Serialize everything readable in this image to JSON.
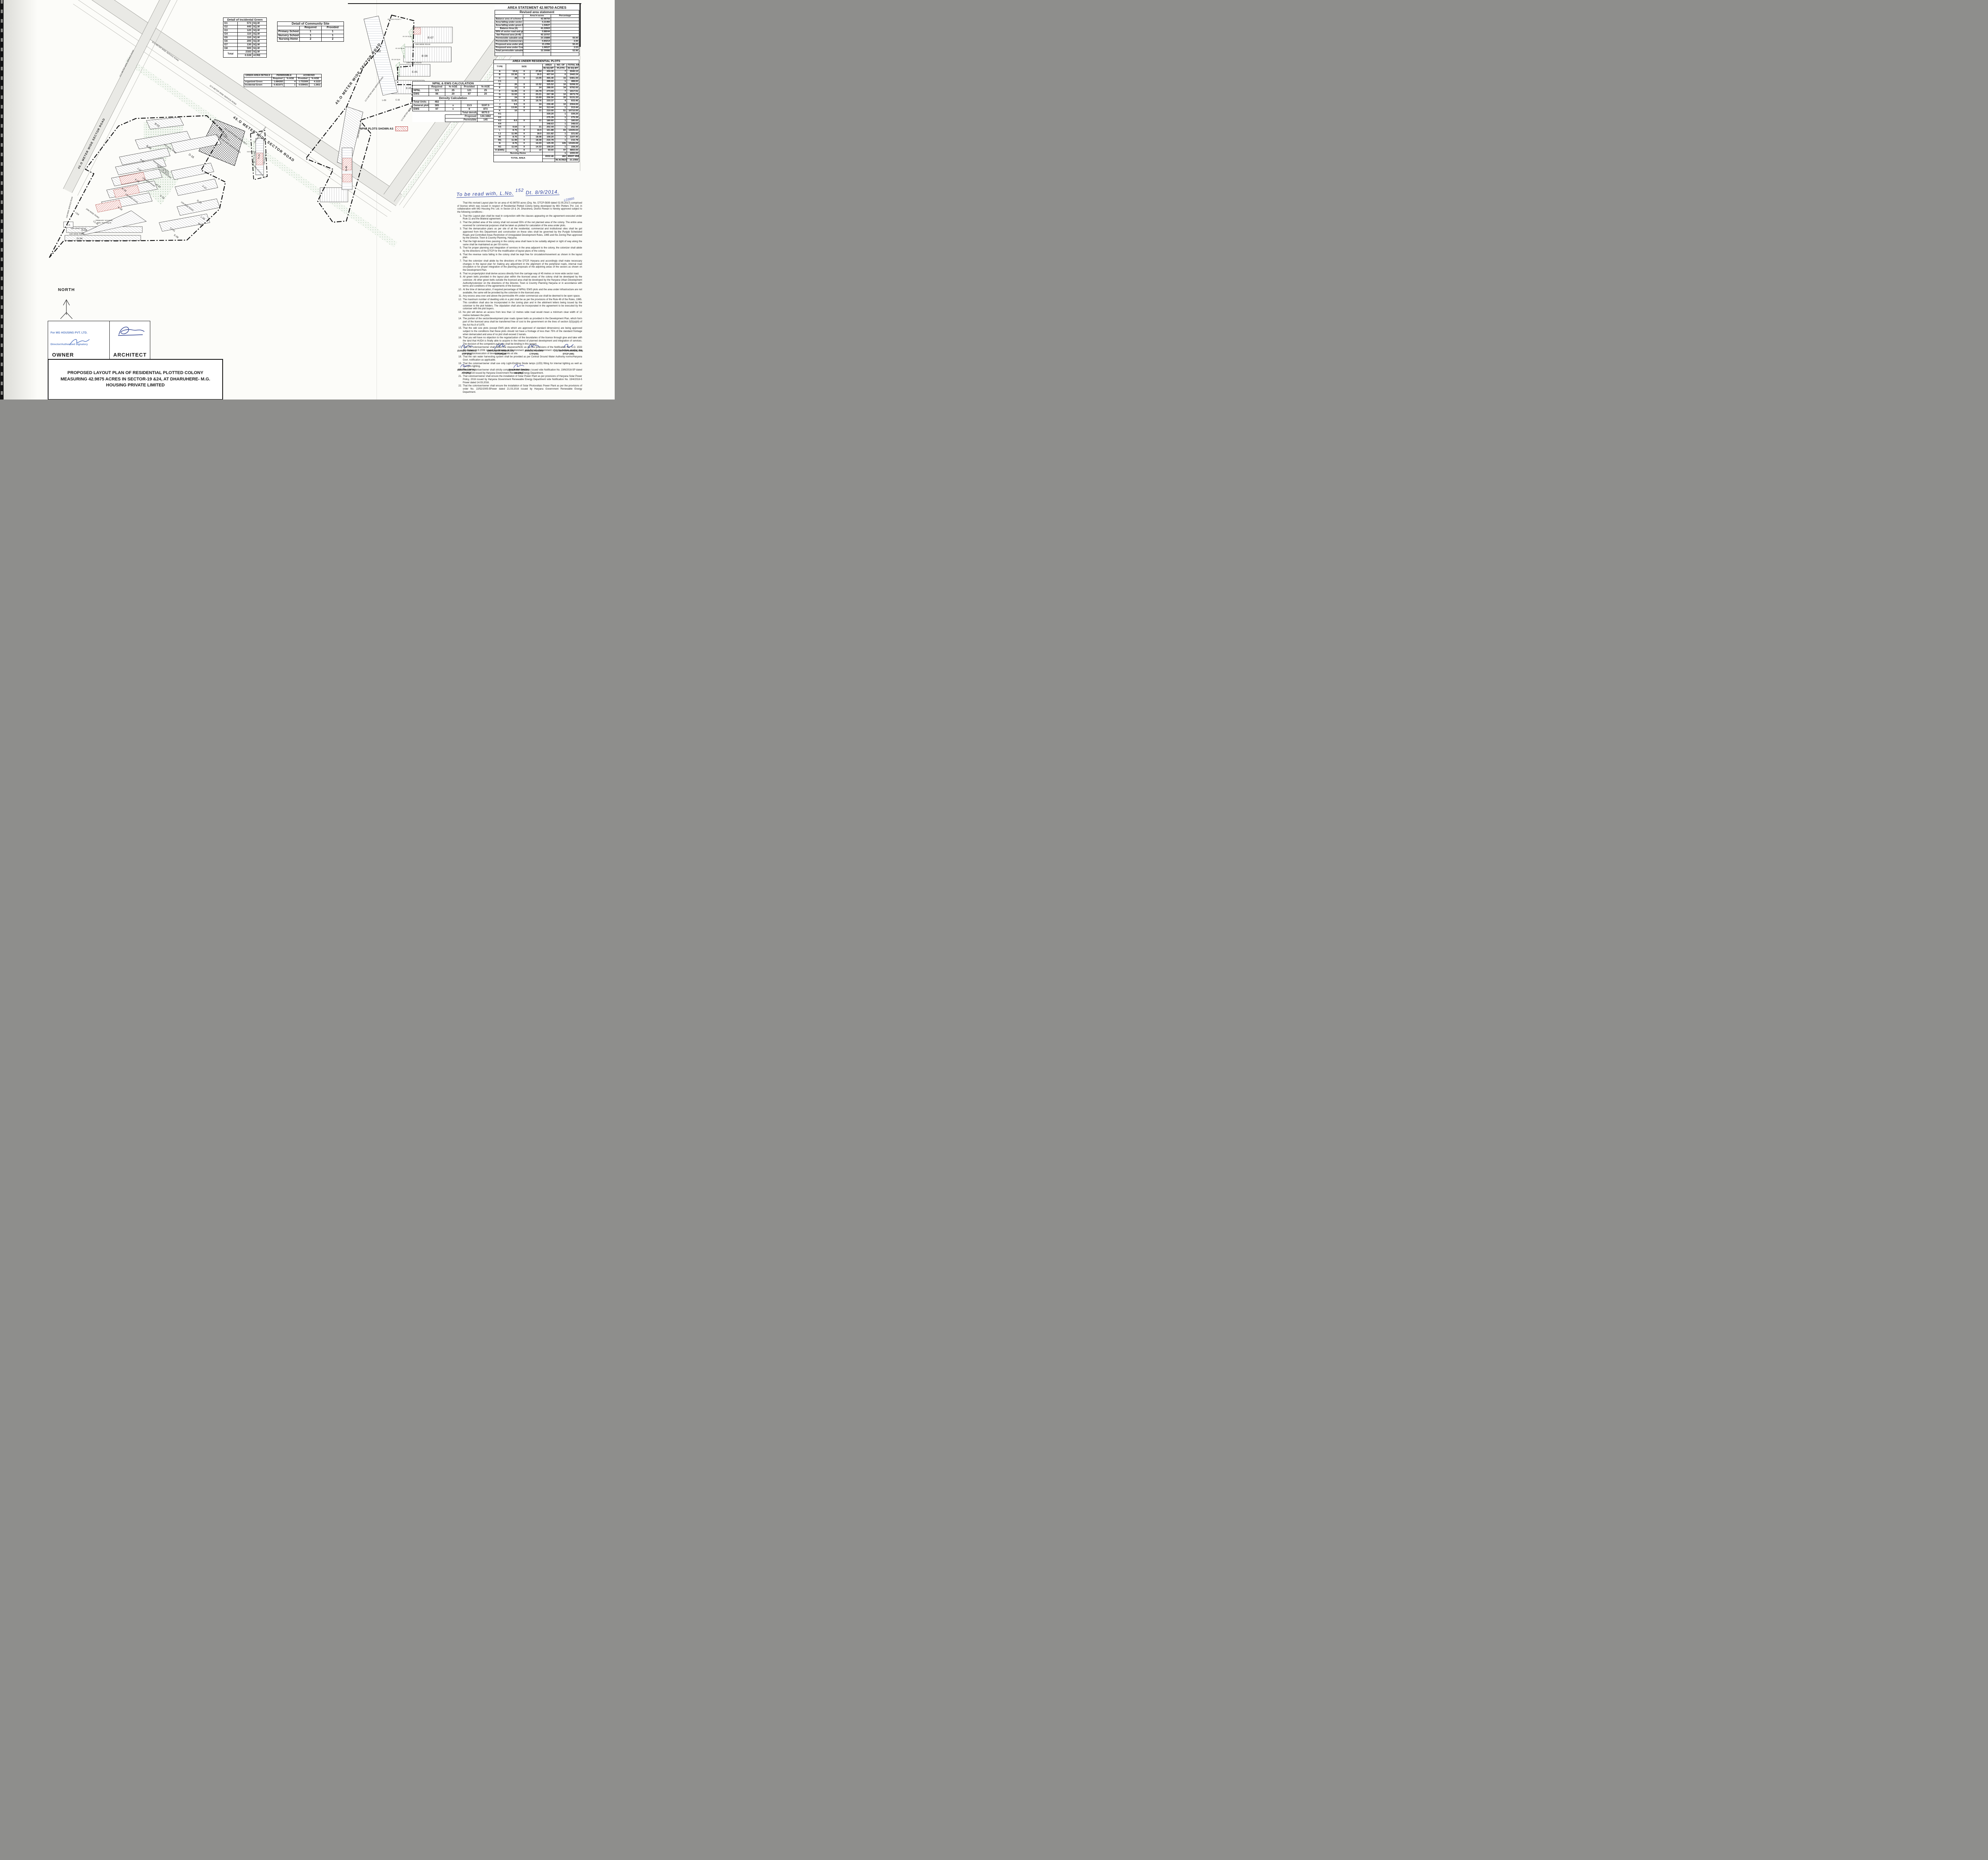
{
  "incidental_green": {
    "title": "Detail of Incidental Green",
    "rows": [
      [
        "G1",
        "573",
        "SQ.M"
      ],
      [
        "G2",
        "440",
        "SQ.M"
      ],
      [
        "G3",
        "120",
        "SQ.M"
      ],
      [
        "G4",
        "110",
        "SQ.M"
      ],
      [
        "G5",
        "110",
        "SQ.M"
      ],
      [
        "G6",
        "200",
        "SQ.M"
      ],
      [
        "G7",
        "130",
        "SQ.M"
      ],
      [
        "G8",
        "500",
        "SQ.M"
      ]
    ],
    "total_label": "Total",
    "total_val1": "2183",
    "total_unit1": "SQ.M",
    "total_val2": "0.539",
    "total_unit2": "ACRE"
  },
  "community_site": {
    "title": "Detail of Community Site",
    "headers": [
      "Required",
      "Provided"
    ],
    "rows": [
      [
        "Primary School",
        "1",
        "1"
      ],
      [
        "Nursery School",
        "1",
        "1"
      ],
      [
        "Nursing Home",
        "2",
        "2"
      ]
    ]
  },
  "green_area": {
    "title": "GREEN AREA DETAILS",
    "group1": "PERMISSIBLE",
    "group2": "ACHIEVED",
    "h1": "Required",
    "h2": "%-AGE",
    "h3": "Provided",
    "h4": "%-AGE",
    "rows": [
      [
        "organized Green",
        "1.684283",
        "4",
        "1.731509",
        "4.1122"
      ],
      [
        "Incidental Green",
        "0.421071",
        "1",
        "0.539431",
        "1.2811"
      ]
    ]
  },
  "npnl_ews": {
    "title": "NPNL & EWS CALCULATION",
    "h1": "Required",
    "h2": "%-AGE",
    "h3": "Provided",
    "h4": "%-AGE",
    "rows": [
      [
        "NPNL",
        "121",
        "25",
        "121",
        "25"
      ],
      [
        "EWS",
        "96",
        "20",
        "97",
        "20"
      ]
    ],
    "density_title": "Density Calculation",
    "density_rows": [
      [
        "Total Units",
        "482",
        "",
        "",
        ""
      ],
      [
        "General plots",
        "385",
        "x",
        "13.5",
        "5197.5"
      ],
      [
        "EWS",
        "97",
        "x",
        "9",
        "873"
      ]
    ],
    "total_density_label": "Total density",
    "total_density_value": "6070.5",
    "proposed_label": "Proposed",
    "proposed_value": "144.1682",
    "proposed_unit": "PPA",
    "permissible_label": "Permisible",
    "permissible_value": "145",
    "permissible_unit": "PPA",
    "legend": "NPNL PLOTS SHOWN AS"
  },
  "area_statement": {
    "title": "AREA STATEMENT 42.98750 ACRES",
    "subtitle": "Revised area statement",
    "col2": "Area In acres",
    "col3": "Percentage",
    "rows": [
      [
        "Balance area of scheme = 51.10625 - 8.11875",
        "42.98750",
        ""
      ],
      [
        "Area falling under sector road",
        "0.21460",
        ""
      ],
      [
        "Area falling under green belt",
        "1.54627",
        ""
      ],
      [
        "Balance Area (A)",
        "41.22663",
        ""
      ],
      [
        "50% of sector road and green belt  (B)",
        "0.88044",
        ""
      ],
      [
        "Net Planned area (A+B)",
        "42.10707",
        ""
      ],
      [
        "Permisisble saleable area",
        "23.15889",
        "55.00"
      ],
      [
        "Permisisble Commercial area",
        "0.84214",
        "2.00"
      ],
      [
        "Proposed area under plots",
        "21.2356",
        "50.43"
      ],
      [
        "Proposed area under Commercial",
        "1.06527",
        "2.53"
      ],
      [
        "Total permissible saleable area",
        "22.30086",
        "52.96"
      ]
    ]
  },
  "residential": {
    "title": "AREA UNDER RESIDENTIAL PLOTS",
    "h_type": "TYPE",
    "h_size": "SIZE",
    "h_area1": "AREA",
    "h_area2": "IN SQ.MT",
    "h_no1": "NO. OF",
    "h_no2": "PLOTS",
    "h_tot1": "TOTAL AREA",
    "h_tot2": "IN SQ.MT",
    "rows": [
      [
        "A",
        "15.6",
        "X",
        "27.84",
        "434.30",
        "7",
        "3040.13"
      ],
      [
        "B",
        "15.36",
        "X",
        "26.5",
        "407.04",
        "6",
        "2442.24"
      ],
      [
        "C",
        "28",
        "X",
        "13.05",
        "365.40",
        "15",
        "5481.00"
      ],
      [
        "C1",
        "",
        "",
        "",
        "488.60",
        "1",
        "488.60"
      ],
      [
        "D",
        "26",
        "X",
        "12.52",
        "325.52",
        "16",
        "5208.32"
      ],
      [
        "E",
        "12",
        "X",
        "24",
        "288.00",
        "34",
        "9792.00"
      ],
      [
        "F",
        "11.05",
        "X",
        "24.79",
        "273.93",
        "7",
        "1917.51"
      ],
      [
        "G",
        "11.52",
        "X",
        "23.21",
        "267.38",
        "10",
        "2673.79"
      ],
      [
        "H",
        "24",
        "X",
        "10.69",
        "256.56",
        "20",
        "5131.20"
      ],
      [
        "I",
        "11.81",
        "X",
        "19.76",
        "233.37",
        "4",
        "933.46"
      ],
      [
        "J",
        "9.6",
        "X",
        "24",
        "230.40",
        "10",
        "2304.00"
      ],
      [
        "J1",
        "13.06",
        "X",
        "24",
        "313.44",
        "1",
        "313.44"
      ],
      [
        "K",
        "10",
        "X",
        "21",
        "210.00",
        "51",
        "10710.00"
      ],
      [
        "K1",
        "",
        "",
        "",
        "339.20",
        "1",
        "339.20"
      ],
      [
        "K2",
        "",
        "",
        "",
        "275.39",
        "1",
        "275.39"
      ],
      [
        "K3",
        "8.6",
        "X",
        "21",
        "180.60",
        "1",
        "180.60"
      ],
      [
        "K4",
        "",
        "",
        "",
        "348.63",
        "1",
        "348.63"
      ],
      [
        "K5",
        "9.64",
        "X",
        "21",
        "202.44",
        "1",
        "202.44"
      ],
      [
        "L",
        "8.75",
        "X",
        "18.5",
        "161.88",
        "83",
        "13435.63"
      ],
      [
        "L1",
        "11.99",
        "X",
        "18.5",
        "221.82",
        "1",
        "221.82"
      ],
      [
        "M",
        "8.75",
        "X",
        "18.08",
        "158.20",
        "7",
        "1107.40"
      ],
      [
        "M1",
        "11.99",
        "X",
        "18.08",
        "216.78",
        "1",
        "216.78"
      ],
      [
        "N",
        "8.75",
        "X",
        "14.33",
        "125.39",
        "105",
        "13165.69"
      ],
      [
        "N1",
        "11.04",
        "X",
        "14.33",
        "158.20",
        "1",
        "158.20"
      ],
      [
        "O (EWS)",
        "5",
        "X",
        "10",
        "50.00",
        "97",
        "4850.00"
      ]
    ],
    "nursing_label": "Nursing Home",
    "nursing_plots": "1",
    "nursing_total": "1000.00",
    "total_label": "TOTAL AREA",
    "total_area": "6532.46",
    "total_plots": "482",
    "total_sqmt": "85937.4588",
    "acres_label": "IN ACRES",
    "acres_value": "21.2356"
  },
  "handwritten": {
    "part1": "To be read with, L.No.",
    "sup": "152",
    "part2": "Dt. 8/9/2014.",
    "code": "L03885"
  },
  "notes": {
    "intro": "That this revised Layout plan for an area of 42.98750 acres (Drg. No. DTCP-5839 dated 02.05.2017) comprised of licence which was issued in respect of Residential Plotted Colony being developed by MG Plotters Pvt. Ltd. in collaboration with MG Housing Pvt. Ltd. in Sector-19 & 24, Dharuhera, District Rewari is hereby approved subject to the following conditions:-",
    "items": [
      "That this Layout plan shall be read in conjunction with the clauses appearing on the agreement executed under Rule 11 and the bilateral agreement.",
      "That the plotted area of the colony shall not exceed 55% of the net planned area of the colony. The entire area reserved for commercial purposes shall be taken as plotted for calculation of the area under plots.",
      "That the demarcation plans as per site of all the residential, commercial and institutional sites shall be got approved from this Department and construction on these sites shall be governed by the Punjab Scheduled Roads and Controlled Areas Restriction of Unregulated Development Rules, 1965 and the Zoning Plan approved by the Director, Town & Country Planning, Haryana.",
      "That the high-tension lines passing in the colony area shall have to be suitably aligned or right of way along the same shall be maintained as per ISI norms.",
      "That for proper planning and integration of services in the area adjacent to the colony, the colonizer shall abide by the directions of the DTCP for the modification of layout plans of the colony.",
      "That the revenue rasta falling in the colony shall be kept free for circulation/movement as shown in the layout plan.",
      "That the colonizer shall abide by the directions of the DTCP, Haryana and accordingly shall make necessary changes in the layout plan for making any adjustment in the alignment of the peripheral roads, internal road circulation or for proper integration of the planning proposals of the adjoining areas of the sectors as shown on the Development Plan.",
      "That no property/plot shall derive access directly from the carriage way of 45 metres or more wide sector road.",
      "All green belts provided in the layout plan within the licenced areas of the colony shall be developed by the colonizer. All other green belts outside the licenced area shall be developed by the Haryana Urban Development Authority/colonizer on the directions of the Director, Town & Country Planning Haryana or in accordance with terms and conditions of the agreements of the licenses.",
      "At the time of demarcation, if required percentage of NPNL/ EWS plots and the area under infrastructure are not available, the same will be provided by the colonizer in the licenced area.",
      "Any excess area over and above the permissible 4% under commercial use shall be deemed to be open space.",
      "The maximum number of dwelling units in a plot shall be as per the provisions of the Rule 49 of the Rules, 1965. This condition shall also be incorporated in the zoning plan and in the allotment letters being issued by the coloniser to the plot holders. The stipulation shall also be incorporated in the agreement to be executed by the coloniser with the plot buyers.",
      "No plot will derive an access from less than 12 metres wide road would mean a minimum clear width of 12 metres between the plots.",
      "The portion of the sector/development plan roads /green belts as provided in the Development Plan, which form part of the licenced area shall be transferred free of cost to the government on the lines of section 3(3)(a)(iii) of the Act No.8 of 1975.",
      "That the odd size plots (except EWS plots which are approved of standard dimensions) are being approved subject to the conditions that these plots should not have a frontage of less than 75% of the standard frontage when demarcated and area of no plot shall exceed 2 kanals.",
      "That you will have no objection to the regularization of the boundaries of the licence through give and take with the land that HUDA is finally able to acquire in the interest of planned development and integration of services. The decision of the competent authority shall be binding in this regard.",
      "That the coloniser/owner shall obtain the clearance/NOC as per the provisions of the Notification No. S.O. 1533 (E) Dated 14.9.2006 issued by Ministry of Environment and Forest, Government of India before starting the construction/execution of development works at site.",
      "That the rain water harvesting system shall be provided as per Central Ground Water Authority norms/Haryana Govt. notification as applicable.",
      "That the coloniser/owner shall use only Light-Emitting Diode lamps (LED) fitting for internal lighting as well as Campus lighting.",
      "That the coloniser/owner shall strictly comply with the directions issued vide Notification No. 19/6/2016-5P dated 31.03.2016 issued by Haryana Government Renewable Energy Department.",
      "That coloniser/owner shall ensure the installation of Solar Power Plant as per provisions of Haryana Solar Power Policy, 2016 issued by Haryana Government Renewable Energy Department vide Notification No. 19/4/2016-5 Power dated 14.03.2016.",
      "That the coloniser/owner shall ensure the installation of Solar Photovoltaic Power Plant as per the provisions of order No. 22/52/2005-5Power dated 21.03.2016 issued by Haryana Government Renewable Energy Department."
    ]
  },
  "signatures_row1": [
    {
      "name": "(SANJAY KUMAR)",
      "title": "DTP (HQ)"
    },
    {
      "name": "(DEVENDRA NIMBOKAR)",
      "title": "STP(HQ)M"
    },
    {
      "name": "(KAMAL KUMAR)",
      "title": "CTP(HR)"
    },
    {
      "name": "(T.L. SATYAPRAKASH, IAS)",
      "title": "DTCP (HR)"
    }
  ],
  "signatures_row2": [
    {
      "name": "(BABITA GUPTA)",
      "title": "ATP(HQ)"
    },
    {
      "name": "(BALWANT SINGH)",
      "title": "SD (HQ)"
    }
  ],
  "owner_block": {
    "stamp1": "For MG HOUSING PVT. LTD.",
    "stamp2": "Director/Authorized Signatory",
    "owner": "OWNER",
    "architect": "ARCHITECT"
  },
  "north_label": "NORTH",
  "title_block": {
    "line": "PROPOSED LAYOUT PLAN OF RESIDENTIAL PLOTTED COLONY MEASURING 42.9875 ACRES IN SECTOR-19 &24, AT DHARUHERE- M.G. HOUSING PRIVATE LIMITED"
  },
  "plan": {
    "t": {
      "sector45": "45.O METER WIDE SECTOR ROAD",
      "svc125": "12.5 METER WIDE SERVICE ROAD",
      "svc120": "12.O METER WIDE SERVICE ROAD",
      "green18": "18.O METER WIDE GREEN BELT",
      "road12": "12M WIDE ROAD",
      "road24": "24M WIDE ROAD",
      "svc12m": "12M WIDE SERVICE ROAD",
      "b03": "B-03",
      "d16": "D-16",
      "a07": "A-07",
      "j10": "J-10",
      "k15": "K-15",
      "k18": "K-18",
      "h20": "H-20",
      "c15": "C-15",
      "i04": "I-04",
      "f07": "F-07",
      "g10": "G-10",
      "l06": "L-06",
      "m07": "M-07",
      "e08": "E-08",
      "c101": "C1-01",
      "o5": "O-5",
      "o58": "O-58",
      "o34": "O-34",
      "e07": "E-07",
      "e09": "E-09",
      "e05": "E-05",
      "l52": "L-52",
      "l09": "L-09",
      "c16": "C-16",
      "n46": "N-46",
      "n26": "N-26",
      "g3": "G3 120 SQ.M.",
      "g4": "G4 110 SQ.M.",
      "g5": "G5 110 SQ.M.",
      "g8": "G8 500 SQ.M.",
      "mb": "M.B.",
      "school1": "PRIMARY SCHOOL",
      "school2": "4091.7647 SQ.M.",
      "org1": "ORGANISED GREEN",
      "org2": "7007.1736 SQ.M.",
      "org3": "1.731509 ACRES",
      "comm1": "COMMERCIAL",
      "comm2": "4311 SQM",
      "comm3": "1.0653 acres",
      "svcpocket": "SERVICES POCKET-1"
    },
    "colors": {
      "npnl_hatch": "#d98a84",
      "green_dots": "#6f9e6f",
      "handwriting_blue": "#2b3f9e",
      "stamp_blue": "#5b7fc4",
      "road_gray": "#e4e4e0"
    }
  }
}
